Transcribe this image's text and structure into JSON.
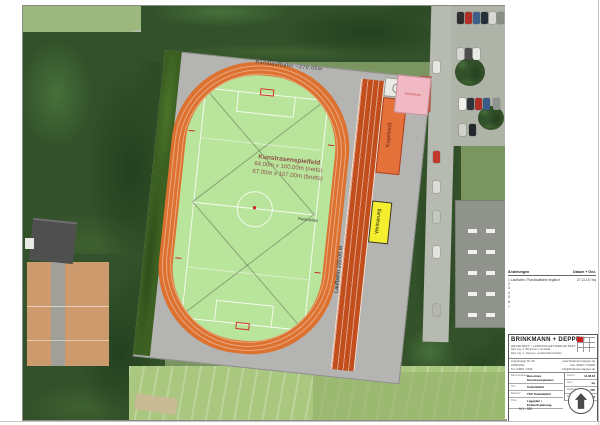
{
  "plan": {
    "track_label": "Rundlaufbahn ~270.00m",
    "field_title": "Kunstrasenspielfeld",
    "field_dim_netto": "64.00m x 100.00m (netto)",
    "field_dim_brutto": "67.00m x 107.00m (brutto)",
    "grass_label": "Rasenplatz",
    "sprint_label": "Laufbahn 100.00 m",
    "shotput_label": "Kugelstoß",
    "longjump_label": "Weitsprung",
    "building_label": "Vereinsheim",
    "colors": {
      "track": "#dd7230",
      "sprint_track": "#c24e1e",
      "infield": "#b9e49c",
      "apron": "#b4b4b2",
      "longjump_pit": "#f5ee2f",
      "shotput_area": "#e4713a",
      "building_pink": "#f0b9c4",
      "accent_red": "#cc2222"
    }
  },
  "revisions": {
    "header_left": "Änderungen",
    "header_right": "Datum + Gez.",
    "rows": [
      {
        "num": "1",
        "text": "Laufbahn / Rundlaufbahn ergänzt",
        "date": "27.11.19 / bq"
      },
      {
        "num": "2",
        "text": "",
        "date": ""
      },
      {
        "num": "3",
        "text": "",
        "date": ""
      },
      {
        "num": "4",
        "text": "",
        "date": ""
      },
      {
        "num": "5",
        "text": "",
        "date": ""
      },
      {
        "num": "6",
        "text": "",
        "date": ""
      },
      {
        "num": "7",
        "text": "",
        "date": ""
      }
    ]
  },
  "titleblock": {
    "firm": "BRINKMANN + DEPPEN",
    "firm_sub": "ARCHITEKT / LANDSCHAFTSARCHITEKT",
    "firm_line1": "Dipl.-Ing. A. Brinkmann, Architekt",
    "firm_line2": "Dipl.-Ing. C. Deppen, Landschaftsarchitekt",
    "contact_left1": "Lütjenburger Str. 60",
    "contact_left2": "24306 Plön",
    "contact_left3": "Tel.: 04522 / 2344",
    "contact_right1": "www.brinkmann-deppen.de",
    "contact_right2": "Fax: 04522 / 744394",
    "contact_right3": "info@brinkmann-deppen.de",
    "rows": [
      {
        "label": "Bauvorhaben:",
        "value": "Bau eines Kunstrasenplatzes"
      },
      {
        "label": "Ort:",
        "value": "Todenbüttel"
      },
      {
        "label": "Bauherr:",
        "value": "TSV Todenbüttel"
      },
      {
        "label": "Plan:",
        "value": "Lageplan / Entwurfsplanung"
      }
    ],
    "meta": [
      {
        "label": "Datum:",
        "value": "14.08.18"
      },
      {
        "label": "Gez.:",
        "value": "bq"
      },
      {
        "label": "Maßstab:",
        "value": "1 : 500"
      },
      {
        "label": "Plan-Nr.:",
        "value": "11.002"
      }
    ],
    "scale_note": "M 1 : 500"
  }
}
